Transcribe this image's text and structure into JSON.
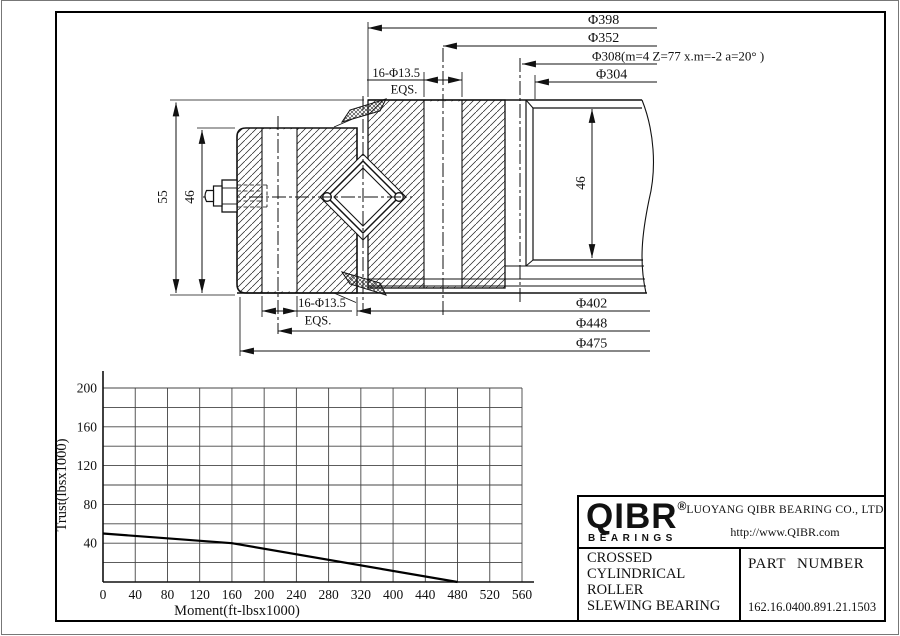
{
  "drawing": {
    "top_dims": [
      "Φ398",
      "Φ352",
      "Φ308(m=4 Z=77 x.m=-2 a=20° )",
      "Φ304"
    ],
    "bottom_dims": [
      "Φ402",
      "Φ448",
      "Φ475"
    ],
    "bolt_pattern_top": {
      "count_size": "16-Φ13.5",
      "spacing": "EQS."
    },
    "bolt_pattern_bottom": {
      "count_size": "16-Φ13.5",
      "spacing": "EQS."
    },
    "overall_height": "55",
    "inner_ring_height": "46",
    "gear_ring_height": "46"
  },
  "chart_data": {
    "type": "line",
    "title": "",
    "xlabel": "Moment(ft-lbsx1000)",
    "ylabel": "Trust(lbsx1000)",
    "xtick_labels": [
      "0",
      "40",
      "80",
      "120",
      "160",
      "200",
      "240",
      "280",
      "320",
      "400",
      "440",
      "480",
      "520",
      "560"
    ],
    "ytick_labels": [
      "40",
      "80",
      "120",
      "160",
      "200"
    ],
    "ylim": [
      0,
      200
    ],
    "ygrid_step": 20,
    "grid": true,
    "legend_position": "none",
    "series": [
      {
        "name": "load capacity curve",
        "points": [
          [
            0,
            50
          ],
          [
            160,
            40
          ],
          [
            480,
            0
          ]
        ],
        "color": "#000000",
        "note": "x positions follow tick index; printed x labels skip 360"
      }
    ]
  },
  "title_block": {
    "logo_text": "QIBR",
    "logo_reg": "®",
    "logo_sub": "BEARINGS",
    "company": "LUOYANG QIBR BEARING CO., LTD",
    "website": "http://www.QIBR.com",
    "product_line1": "CROSSED CYLINDRICAL",
    "product_line2": "ROLLER",
    "product_line3": "SLEWING BEARING",
    "part_number_label": "PART NUMBER",
    "part_number": "162.16.0400.891.21.1503"
  }
}
